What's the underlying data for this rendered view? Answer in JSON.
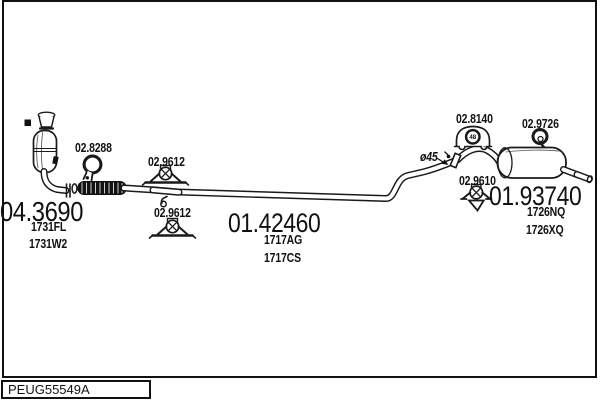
{
  "panel": {
    "catalog_code": "PEUG55549A",
    "colors": {
      "line": "#1a1a1a",
      "background": "#ffffff"
    },
    "parts": {
      "catalyst": {
        "part_number": "04.3690",
        "oe_codes": [
          "1731FL",
          "1731W2"
        ]
      },
      "centre_pipe": {
        "part_number": "01.42460",
        "oe_codes": [
          "1717AG",
          "1717CS"
        ]
      },
      "rear_silencer": {
        "part_number": "01.93740",
        "oe_codes": [
          "1726NQ",
          "1726XQ"
        ]
      }
    },
    "fittings": {
      "front_clamp": "02.8288",
      "mid_bracket_upper": "02.9612",
      "mid_bracket_lower": "02.9612",
      "rear_clamp": "02.8140",
      "rear_clamp_size": "48",
      "rear_hanger_top": "02.9726",
      "rear_hanger_bottom": "02.9610",
      "pipe_diameter": "ø45"
    }
  }
}
